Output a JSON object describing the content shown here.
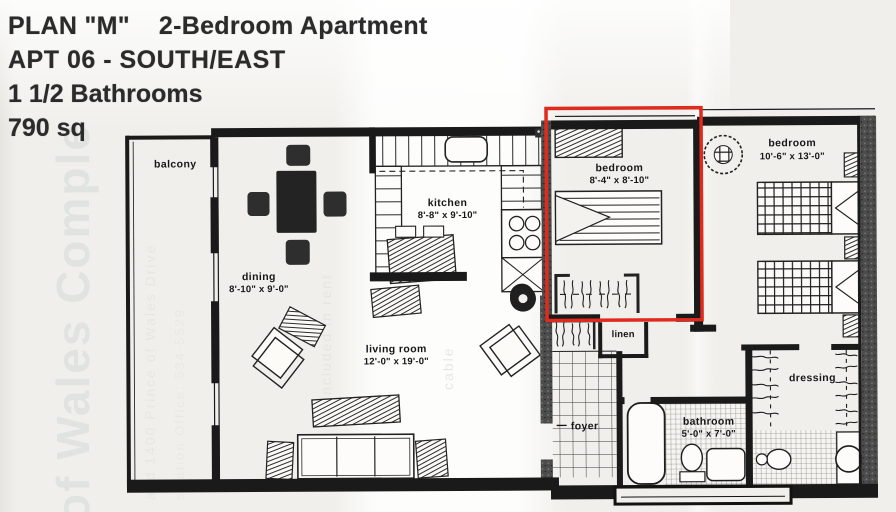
{
  "header": {
    "line1": "PLAN \"M\"    2-Bedroom Apartment",
    "line2": "APT 06 - SOUTH/EAST",
    "line3": "1 1/2 Bathrooms",
    "line4": "790 sq"
  },
  "rooms": {
    "balcony": {
      "label": "balcony"
    },
    "dining": {
      "label": "dining",
      "dims": "8'-10\" x 9'-0\""
    },
    "kitchen": {
      "label": "kitchen",
      "dims": "8'-8\" x 9'-10\""
    },
    "living": {
      "label": "living room",
      "dims": "12'-0\" x 19'-0\""
    },
    "bedroom_small": {
      "label": "bedroom",
      "dims": "8'-4\" x 8'-10\"",
      "highlighted": true
    },
    "bedroom_large": {
      "label": "bedroom",
      "dims": "10'-6\" x 13'-0\""
    },
    "linen": {
      "label": "linen"
    },
    "foyer": {
      "label": "foyer"
    },
    "bathroom": {
      "label": "bathroom",
      "dims": "5'-0\" x 7'-0\""
    },
    "dressing": {
      "label": "dressing"
    }
  },
  "highlight": {
    "color": "#e02a1e",
    "room": "bedroom_small"
  },
  "watermarks": {
    "large": "of Wales Comple",
    "wm2": "and 1400 Prince of Wales Drive",
    "wm3": "stration Office:  534-5529",
    "wm4": "included in rent",
    "wm5": "cable"
  },
  "colors": {
    "ink": "#1c1c1c",
    "paper": "#f0efeb",
    "wall_stipple": "#4c4c4c"
  }
}
